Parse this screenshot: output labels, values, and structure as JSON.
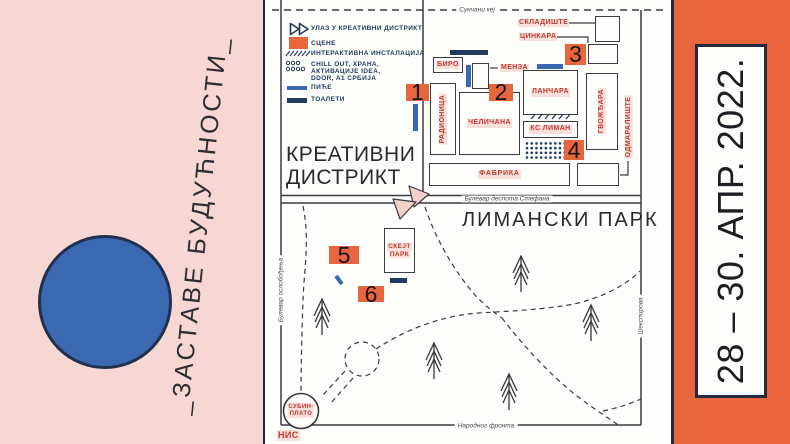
{
  "colors": {
    "orange": "#E8653E",
    "pink": "#F6D7D3",
    "blue": "#3A69B2",
    "navy": "#223A5E",
    "red_label": "#C23A31",
    "line": "#3B3B42"
  },
  "left_panel": {
    "brand_text": "_ЗАСТАВЕ БУДУЋНОСТИ_"
  },
  "right_panel": {
    "dates": "28 – 30. АПР. 2022."
  },
  "map": {
    "legend": {
      "entrance": "УЛАЗ У КРЕАТИВНИ ДИСТРИКТ",
      "stages": "СЦЕНЕ",
      "installation": "ИНТЕРАКТИВНА ИНСТАЛАЦИЈА",
      "chill_line1": "CHILL OUT, ХРАНА,",
      "chill_line2": "АКТИВАЦИЈЕ IDEA,",
      "chill_line3": "DDOR, A1 СРБИЈА",
      "drinks": "ПИЋЕ",
      "toilets": "ТОАЛЕТИ"
    },
    "district": {
      "title_line1": "КРЕАТИВНИ",
      "title_line2": "ДИСТРИКТ",
      "buildings": {
        "biro": "БИРО",
        "menza": "МЕНЗА",
        "radionica": "РАДИОНИЦА",
        "celicana": "ЧЕЛИЧАНА",
        "lancara": "ЛАНЧАРА",
        "ks_liman": "КС ЛИМАН",
        "gvozdjara": "ГВОЖЂАРА",
        "skladiste": "СКЛАДИШТЕ",
        "cinkara": "ЦИНКАРА",
        "fabrika": "ФАБРИКА",
        "odmaraliste": "ОДМАРАЛИШТЕ"
      },
      "markers": [
        "1",
        "2",
        "3",
        "4"
      ]
    },
    "park": {
      "title": "ЛИМАНСКИ ПАРК",
      "skate_line1": "СКЕЈТ",
      "skate_line2": "ПАРК",
      "markers": [
        "5",
        "6"
      ],
      "plato_line1": "СУБИН-",
      "plato_line2": "ПЛАТО"
    },
    "streets": {
      "top": "Сунчани кеј",
      "boulevard": "Булевар деспота Стефана",
      "bottom": "Народног фронта",
      "left": "Булевар ослобођења",
      "right": "Шекспирова"
    },
    "poi": {
      "nis": "НИС"
    }
  }
}
